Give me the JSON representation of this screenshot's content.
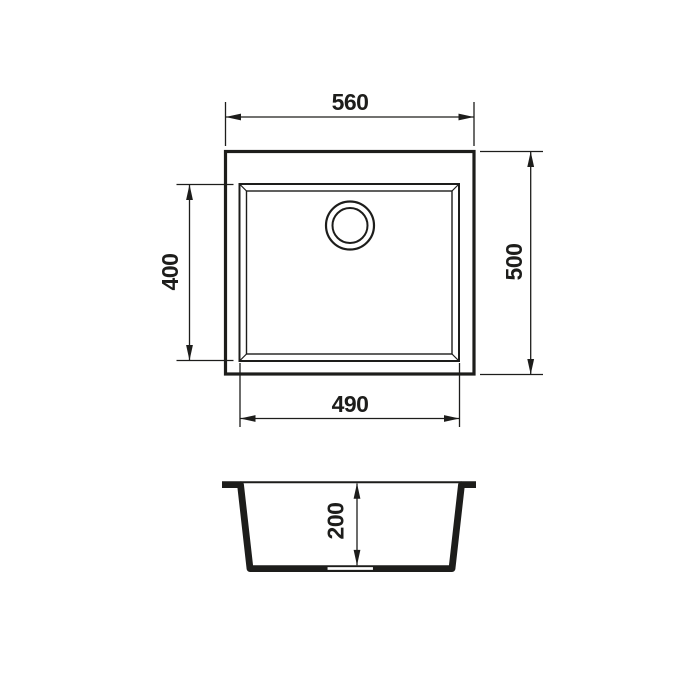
{
  "drawing": {
    "description": "Kitchen sink dimensional technical drawing with plan view and section view",
    "background_color": "#ffffff",
    "line_color": "#1d1d1b",
    "plan_view": {
      "overall_width": "560",
      "overall_depth": "500",
      "bowl_width": "490",
      "bowl_depth": "400"
    },
    "section_view": {
      "bowl_height": "200"
    }
  }
}
